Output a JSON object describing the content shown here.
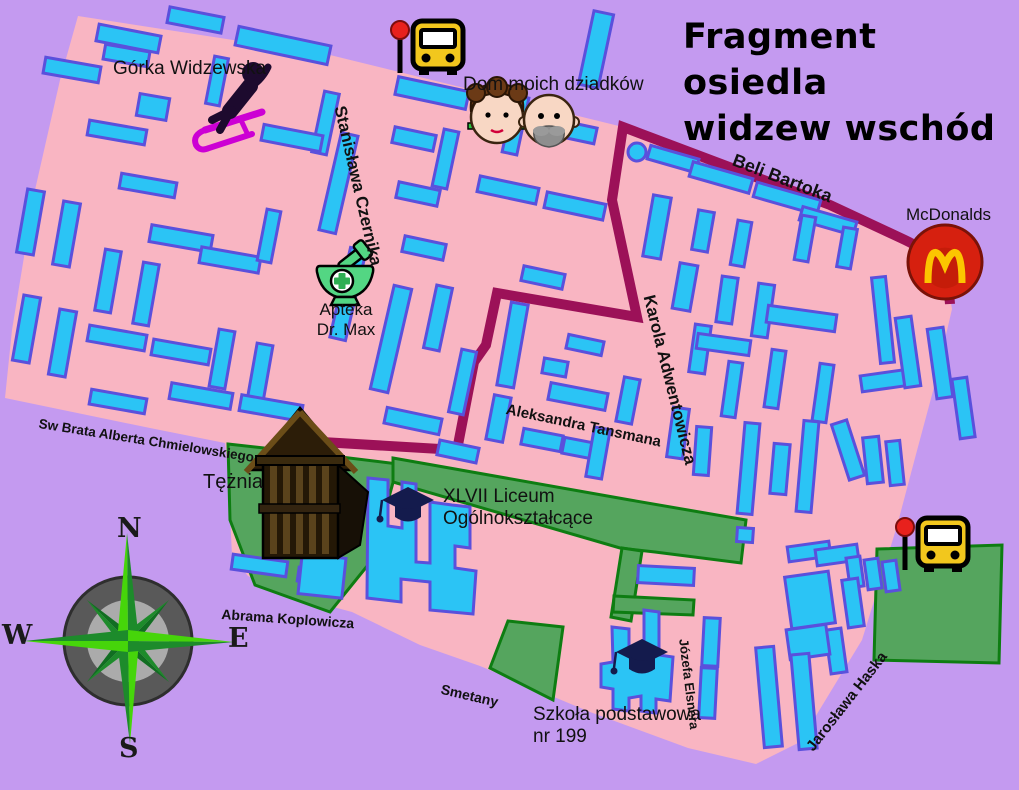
{
  "title": {
    "line1": "Fragment osiedla",
    "line2": "widzew wschód"
  },
  "landmarks": {
    "gorka": {
      "label": "Górka Widzewska"
    },
    "grandparents": {
      "label": "Dom moich dziadków"
    },
    "apteka": {
      "line1": "Apteka",
      "line2": "Dr. Max"
    },
    "mcdonalds": {
      "label": "McDonalds"
    },
    "teznia": {
      "label": "Tężnia"
    },
    "liceum": {
      "line1": "XLVII Liceum",
      "line2": "Ogólnokształcące"
    },
    "szkola": {
      "line1": "Szkoła podstawowa",
      "line2": "nr 199"
    }
  },
  "streets": [
    {
      "label": "Stanisława Czernika",
      "x": 349,
      "y": 104,
      "rot": 77,
      "size": 17
    },
    {
      "label": "Beli Bartoka",
      "x": 737,
      "y": 150,
      "rot": 21,
      "size": 18
    },
    {
      "label": "Karola Adwentowicza",
      "x": 658,
      "y": 293,
      "rot": 76,
      "size": 17
    },
    {
      "label": "Aleksandra Tansmana",
      "x": 508,
      "y": 401,
      "rot": 12,
      "size": 15
    },
    {
      "label": "Sw Brata Alberta Chmielowskiego",
      "x": 40,
      "y": 416,
      "rot": 9,
      "size": 13.5
    },
    {
      "label": "Abrama Koplowicza",
      "x": 222,
      "y": 606,
      "rot": 4,
      "size": 14
    },
    {
      "label": "Smetany",
      "x": 443,
      "y": 681,
      "rot": 13,
      "size": 14
    },
    {
      "label": "Józefa Elsnera",
      "x": 690,
      "y": 638,
      "rot": 83,
      "size": 13
    },
    {
      "label": "Jarosława Haska",
      "x": 803,
      "y": 744,
      "rot": -52,
      "size": 15
    }
  ],
  "compass": {
    "north": "N",
    "south": "S",
    "east": "E",
    "west": "W"
  },
  "icons": [
    "bus-stop-icon",
    "sledding-icon",
    "grandma-face-icon",
    "grandpa-face-icon",
    "mortar-pestle-icon",
    "mcdonalds-m-icon",
    "graduation-cap-icon",
    "wooden-tower-icon",
    "compass-rose-icon"
  ],
  "colors": {
    "background": "#c49af0",
    "estate": "#f9b5c2",
    "building_fill": "#2bc4f5",
    "building_stroke": "#5a50dc",
    "road": "#9c1158",
    "green_fill": "#55a55e",
    "green_stroke": "#0e7d12",
    "bus_yellow": "#f2c71d",
    "stop_red": "#e8211d",
    "mcd_red": "#d6200f",
    "mcd_yellow": "#fcc500",
    "mortar_green": "#53d683",
    "cross_green": "#2fae53",
    "cap_navy": "#141b4d",
    "sled_magenta": "#cc00d4",
    "compass_ring": "#595959",
    "compass_inner": "#ababab",
    "star_bright": "#46d50a",
    "star_dark": "#1d8b2b",
    "wood_dark": "#241806",
    "wood_light": "#5a431c",
    "skin": "#f8d7c4",
    "hair_brown": "#6b3a16",
    "beard_gray": "#8e8e8e"
  },
  "map": {
    "outline": "78,16 330,55 623,127 830,205 907,240 946,276 952,309 933,391 915,458 897,526 862,640 800,742 756,764 688,748 590,712 480,666 420,645 352,612 300,598 248,576 232,556 228,470 225,443 150,428 5,398 12,330 35,190 60,80",
    "greens": [
      "228,444 300,452 398,464 372,560 330,612 255,585 230,520",
      "393,458 630,500 746,520 741,563 655,552 620,548 393,482",
      "622,548 642,551 631,621 611,617",
      "614,596 694,600 693,615 613,612",
      "508,621 563,627 553,700 490,668",
      "877,549 1002,545 999,663 874,660"
    ],
    "road_path": "M 950,304 Q 948,260 905,240 L 830,205 L 623,127 L 612,200 L 637,317 L 497,293 L 486,345 L 474,362 L 457,450 L 305,441",
    "dot": {
      "x": 637,
      "y": 152,
      "r": 9
    },
    "liceum_poly": "368,478 388,480 388,526 402,528 402,482 416,484 416,562 430,563 430,502 452,505 470,507 470,548 455,546 455,568 476,571 473,614 430,610 430,582 401,579 401,602 367,598",
    "szkola_poly": "612,627 629,629 629,654 644,654 644,610 659,612 659,655 673,657 670,701 656,699 656,713 641,711 641,696 629,698 629,711 613,709 613,689 601,687 601,664 613,662",
    "buildings": [
      [
        97,
        30,
        63,
        17,
        11
      ],
      [
        168,
        12,
        55,
        16,
        11
      ],
      [
        236,
        36,
        94,
        19,
        12
      ],
      [
        396,
        84,
        72,
        18,
        12
      ],
      [
        548,
        123,
        48,
        16,
        12
      ],
      [
        586,
        12,
        20,
        75,
        12
      ],
      [
        44,
        62,
        56,
        16,
        10
      ],
      [
        104,
        48,
        45,
        15,
        10
      ],
      [
        648,
        152,
        50,
        14,
        16
      ],
      [
        690,
        170,
        62,
        15,
        16
      ],
      [
        754,
        191,
        66,
        15,
        16
      ],
      [
        800,
        214,
        56,
        14,
        16
      ],
      [
        210,
        57,
        14,
        48,
        11
      ],
      [
        318,
        92,
        15,
        62,
        12
      ],
      [
        138,
        96,
        30,
        22,
        10
      ],
      [
        88,
        125,
        58,
        15,
        10
      ],
      [
        150,
        230,
        62,
        17,
        10
      ],
      [
        120,
        178,
        56,
        15,
        10
      ],
      [
        22,
        190,
        17,
        64,
        10
      ],
      [
        58,
        202,
        17,
        64,
        10
      ],
      [
        18,
        296,
        17,
        66,
        10
      ],
      [
        54,
        310,
        17,
        66,
        10
      ],
      [
        100,
        250,
        16,
        62,
        10
      ],
      [
        138,
        263,
        16,
        62,
        10
      ],
      [
        200,
        252,
        60,
        16,
        10
      ],
      [
        88,
        330,
        58,
        16,
        10
      ],
      [
        152,
        344,
        58,
        16,
        10
      ],
      [
        214,
        330,
        16,
        58,
        10
      ],
      [
        252,
        344,
        16,
        58,
        10
      ],
      [
        170,
        388,
        62,
        16,
        10
      ],
      [
        240,
        400,
        62,
        16,
        10
      ],
      [
        90,
        394,
        56,
        15,
        10
      ],
      [
        262,
        130,
        60,
        16,
        11
      ],
      [
        262,
        210,
        14,
        52,
        11
      ],
      [
        330,
        133,
        17,
        100,
        13
      ],
      [
        340,
        248,
        16,
        92,
        13
      ],
      [
        382,
        286,
        18,
        106,
        13
      ],
      [
        393,
        131,
        42,
        16,
        12
      ],
      [
        397,
        186,
        42,
        16,
        12
      ],
      [
        403,
        240,
        42,
        16,
        12
      ],
      [
        438,
        130,
        15,
        58,
        12
      ],
      [
        508,
        96,
        15,
        58,
        12
      ],
      [
        478,
        182,
        60,
        16,
        12
      ],
      [
        545,
        198,
        60,
        16,
        12
      ],
      [
        430,
        286,
        16,
        64,
        12
      ],
      [
        455,
        350,
        15,
        64,
        12
      ],
      [
        385,
        413,
        56,
        16,
        12
      ],
      [
        504,
        303,
        17,
        84,
        10
      ],
      [
        522,
        270,
        42,
        15,
        12
      ],
      [
        567,
        338,
        36,
        14,
        12
      ],
      [
        543,
        360,
        24,
        15,
        10
      ],
      [
        438,
        444,
        40,
        15,
        12
      ],
      [
        490,
        396,
        17,
        45,
        11
      ],
      [
        549,
        388,
        58,
        17,
        11
      ],
      [
        620,
        378,
        16,
        45,
        11
      ],
      [
        522,
        432,
        40,
        16,
        11
      ],
      [
        563,
        441,
        40,
        16,
        11
      ],
      [
        648,
        196,
        18,
        62,
        10
      ],
      [
        676,
        264,
        18,
        46,
        10
      ],
      [
        692,
        325,
        16,
        48,
        8
      ],
      [
        670,
        408,
        16,
        50,
        8
      ],
      [
        590,
        428,
        16,
        50,
        10
      ],
      [
        695,
        211,
        16,
        40,
        10
      ],
      [
        734,
        221,
        14,
        45,
        10
      ],
      [
        798,
        216,
        14,
        45,
        10
      ],
      [
        840,
        228,
        14,
        40,
        10
      ],
      [
        719,
        277,
        16,
        46,
        8
      ],
      [
        755,
        284,
        16,
        53,
        8
      ],
      [
        767,
        310,
        69,
        17,
        8
      ],
      [
        697,
        337,
        53,
        15,
        8
      ],
      [
        725,
        362,
        14,
        55,
        8
      ],
      [
        768,
        350,
        14,
        58,
        8
      ],
      [
        816,
        364,
        14,
        58,
        8
      ],
      [
        861,
        372,
        56,
        16,
        -8
      ],
      [
        876,
        277,
        14,
        86,
        -6
      ],
      [
        840,
        421,
        16,
        58,
        -18
      ],
      [
        741,
        423,
        15,
        91,
        5
      ],
      [
        772,
        444,
        16,
        50,
        5
      ],
      [
        800,
        421,
        15,
        91,
        5
      ],
      [
        865,
        437,
        16,
        46,
        -6
      ],
      [
        888,
        441,
        14,
        44,
        -6
      ],
      [
        900,
        317,
        16,
        70,
        -8
      ],
      [
        932,
        328,
        16,
        70,
        -8
      ],
      [
        956,
        378,
        15,
        60,
        -8
      ],
      [
        788,
        544,
        42,
        15,
        -8
      ],
      [
        816,
        547,
        42,
        16,
        -8
      ],
      [
        848,
        557,
        14,
        30,
        -8
      ],
      [
        866,
        559,
        14,
        30,
        -8
      ],
      [
        884,
        561,
        14,
        30,
        -8
      ],
      [
        788,
        574,
        44,
        52,
        -8
      ],
      [
        845,
        579,
        16,
        48,
        -8
      ],
      [
        828,
        629,
        16,
        44,
        -8
      ],
      [
        788,
        627,
        40,
        30,
        -8
      ],
      [
        760,
        647,
        18,
        100,
        -5
      ],
      [
        795,
        654,
        18,
        95,
        -5
      ],
      [
        695,
        427,
        15,
        48,
        4
      ],
      [
        638,
        567,
        56,
        17,
        3
      ],
      [
        232,
        558,
        55,
        15,
        8
      ],
      [
        298,
        570,
        42,
        14,
        8
      ],
      [
        703,
        618,
        16,
        48,
        3
      ],
      [
        700,
        668,
        16,
        50,
        3
      ],
      [
        300,
        556,
        44,
        40,
        6
      ],
      [
        737,
        528,
        16,
        14,
        4
      ]
    ],
    "markers": {
      "bus_stops": [
        {
          "x": 400,
          "y": 18
        },
        {
          "x": 905,
          "y": 515
        }
      ],
      "grad_caps": [
        {
          "x": 408,
          "y": 500
        },
        {
          "x": 642,
          "y": 652
        }
      ],
      "mcdonalds": {
        "x": 945,
        "y": 262,
        "r": 37
      },
      "mortar": {
        "x": 342,
        "y": 281
      },
      "grandma": {
        "x": 497,
        "y": 117
      },
      "grandpa": {
        "x": 549,
        "y": 120
      },
      "sled": {
        "x": 230,
        "y": 100
      },
      "tower": {
        "x": 300,
        "y": 485
      },
      "compass": {
        "x": 128,
        "y": 641
      }
    }
  }
}
